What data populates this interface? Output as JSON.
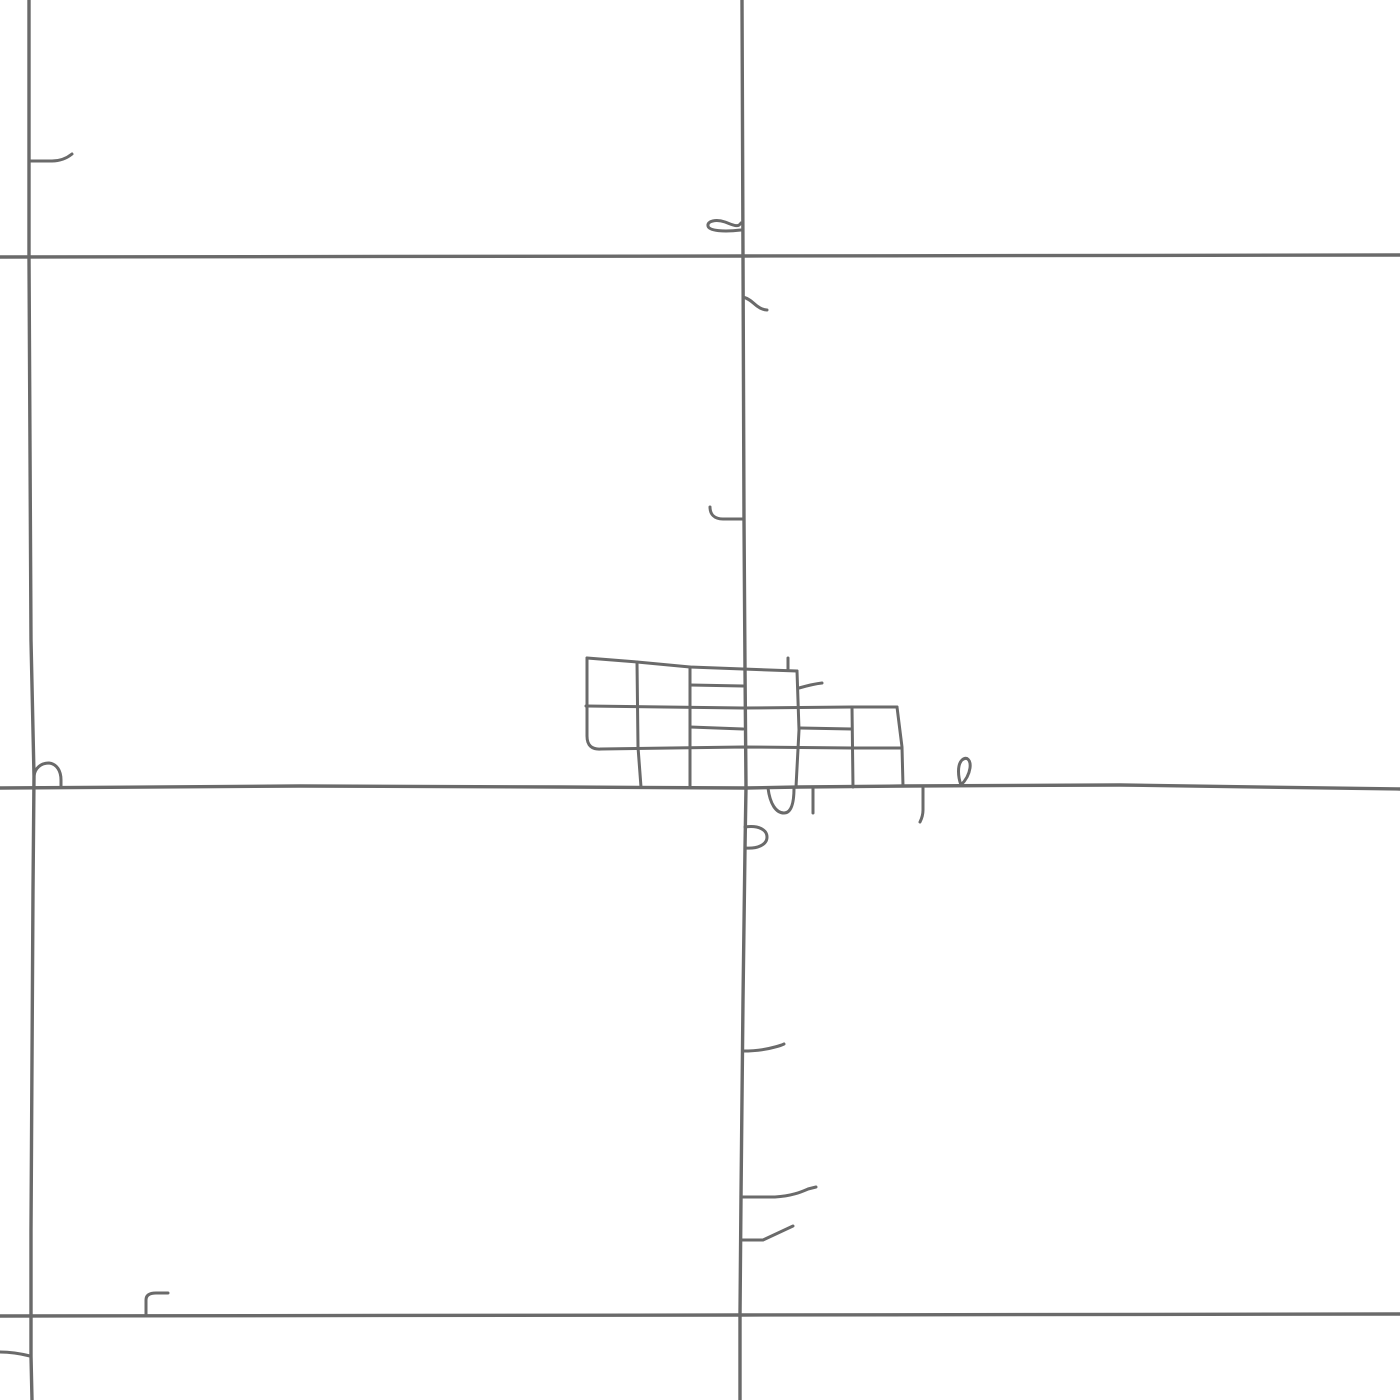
{
  "map": {
    "description": "Monochrome road map tile: rural section-line roads with a small town street grid at center",
    "background_color": "#ffffff",
    "road_color": "#6a6a6a",
    "viewbox": "0 0 1400 1400",
    "stroke_width": {
      "major": 3.4,
      "minor": 3.0
    },
    "roads": [
      {
        "name": "road-vertical-main",
        "type": "major",
        "d": "M742,0 L743,256 L744,520 L745,669 L746,787 L745,848 L743,1000 L741,1197 L740,1315 L740,1400"
      },
      {
        "name": "road-vertical-left",
        "type": "major",
        "d": "M29,0 L29,257 L31,640 L34,776 L33,890 L31,1230 L31,1356 L32,1400"
      },
      {
        "name": "road-horizontal-top",
        "type": "major",
        "d": "M0,257 L742,256 L1400,255"
      },
      {
        "name": "road-horizontal-mid",
        "type": "major",
        "d": "M0,788 L300,786 L560,787 L746,788 L800,787 L905,786 L1120,785 L1400,789"
      },
      {
        "name": "road-horizontal-bottom",
        "type": "major",
        "d": "M0,1316 L740,1315 L1400,1314"
      },
      {
        "name": "grid-top-edge",
        "type": "minor",
        "d": "M587,658 L637,662 L690,667 L743,669 L797,671"
      },
      {
        "name": "grid-west-edge",
        "type": "minor",
        "d": "M587,658 L587,736 Q587,750 601,749"
      },
      {
        "name": "grid-row-upper",
        "type": "minor",
        "d": "M690,685 L743,686"
      },
      {
        "name": "grid-row-mid",
        "type": "minor",
        "d": "M586,706 L743,708 L852,707 L897,707"
      },
      {
        "name": "grid-row-lower-west",
        "type": "minor",
        "d": "M690,727 L743,729"
      },
      {
        "name": "grid-row-lower-east",
        "type": "minor",
        "d": "M800,728 L852,729"
      },
      {
        "name": "grid-row-bottom",
        "type": "minor",
        "d": "M601,749 L743,747 L852,748 L901,748"
      },
      {
        "name": "grid-col-2",
        "type": "minor",
        "d": "M637,662 L638,747 L641,787"
      },
      {
        "name": "grid-col-3",
        "type": "minor",
        "d": "M690,667 L690,787"
      },
      {
        "name": "grid-col-5",
        "type": "minor",
        "d": "M797,671 L799,730 L796,787"
      },
      {
        "name": "grid-col-6",
        "type": "minor",
        "d": "M852,707 L853,787"
      },
      {
        "name": "grid-east-edge",
        "type": "minor",
        "d": "M897,707 L902,747 L903,786"
      },
      {
        "name": "grid-north-stub",
        "type": "minor",
        "d": "M788,658 L788,670"
      },
      {
        "name": "grid-northeast-spur",
        "type": "minor",
        "d": "M799,688 C806,686 813,684 822,683"
      },
      {
        "name": "south-u-loop",
        "type": "minor",
        "d": "M768,788 C770,804 776,813 784,813 C791,813 794,804 794,788"
      },
      {
        "name": "south-stub-inner",
        "type": "minor",
        "d": "M813,788 L813,813"
      },
      {
        "name": "south-p-loop",
        "type": "minor",
        "d": "M745,827 C759,825 767,830 767,837 C767,845 757,849 745,848"
      },
      {
        "name": "south-stub-outer",
        "type": "minor",
        "d": "M923,788 L923,810 C923,816 921,820 920,822"
      },
      {
        "name": "south-rho-loop",
        "type": "minor",
        "d": "M961,785 C958,777 957,765 962,760 C967,756 971,760 970,768 C969,775 966,780 961,785"
      },
      {
        "name": "north-lasso-spur",
        "type": "minor",
        "d": "M741,230 C724,232 709,231 708,226 C707,221 716,219 725,222 C733,225 738,228 741,223"
      },
      {
        "name": "north-wavy-spur",
        "type": "minor",
        "d": "M743,297 C750,299 753,303 757,306 C761,309 764,310 767,310"
      },
      {
        "name": "north-hook-spur",
        "type": "minor",
        "d": "M710,507 C710,514 714,519 723,519 L743,519"
      },
      {
        "name": "southeast-spur-upper",
        "type": "minor",
        "d": "M743,1051 C757,1051 768,1049 775,1047 C779,1046 782,1045 784,1044"
      },
      {
        "name": "southeast-spur-middle",
        "type": "minor",
        "d": "M741,1197 L775,1197 C792,1196 801,1192 808,1189 L816,1187"
      },
      {
        "name": "southeast-spur-lower",
        "type": "minor",
        "d": "M741,1240 L763,1240 L793,1226"
      },
      {
        "name": "northwest-spur",
        "type": "minor",
        "d": "M30,161 L52,161 C61,161 67,158 72,154"
      },
      {
        "name": "west-bump-loop",
        "type": "minor",
        "d": "M34,776 C35,768 41,763 49,763 C57,764 61,771 61,780 L61,787"
      },
      {
        "name": "southwest-edge-spur",
        "type": "minor",
        "d": "M0,1352 C10,1352 22,1354 30,1356"
      },
      {
        "name": "southwest-corner-stub",
        "type": "minor",
        "d": "M146,1314 L146,1300 C146,1295 150,1293 156,1293 L168,1293"
      }
    ]
  }
}
